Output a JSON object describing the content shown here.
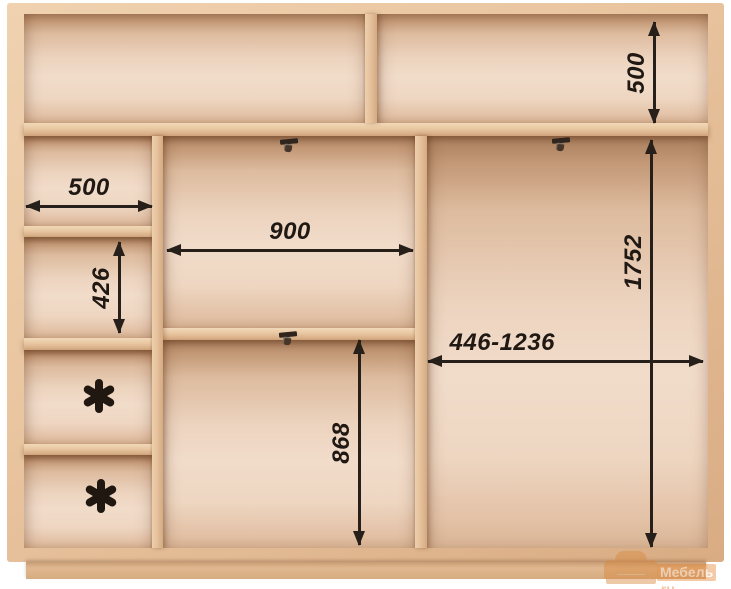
{
  "diagram": {
    "kind": "wardrobe-interior-schematic",
    "dimensions": {
      "top_right_height": "500",
      "left_shelf_width": "500",
      "left_opening_height": "426",
      "middle_opening_width": "900",
      "middle_lower_height": "868",
      "right_opening_height": "1752",
      "right_adjustable_width": "446-1236"
    },
    "asterisk_symbol": "*",
    "colors": {
      "wood_face": "#e9c5a0",
      "wood_edge_dark": "#d5aa81",
      "interior_light": "#f1dcca",
      "interior_shadow": "#a87d5c",
      "dimension_ink": "#27201a",
      "watermark_orange": "#d8883f"
    }
  },
  "watermark": {
    "brand_name": "Мебель",
    "brand_suffix": ".ru"
  }
}
